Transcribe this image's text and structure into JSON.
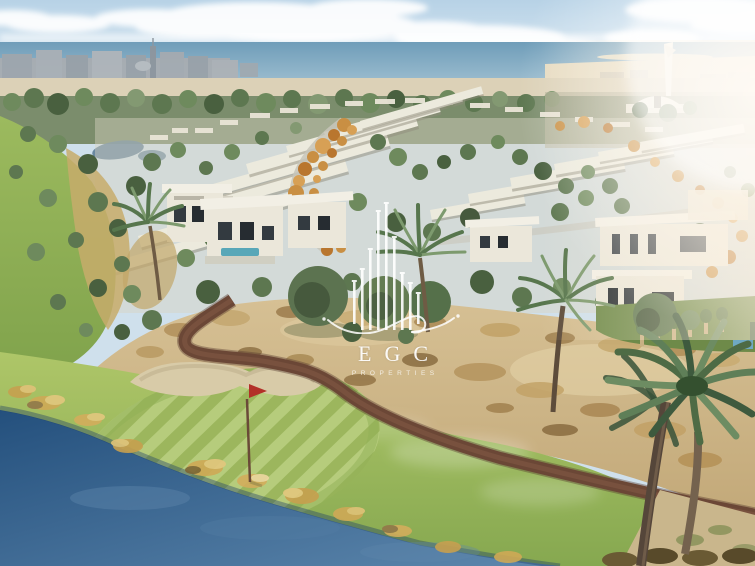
{
  "scene": {
    "alt": "Aerial architectural rendering of a seaside golf-course villa community: white flat-roof villas among green and autumn trees, a mosque with minaret near the shoreline, a striped putting green with red flag, sand bunker, desert scrub, winding brown cart path, blue pond with golden reeds and foreground date palms."
  },
  "watermark": {
    "name": "EGC",
    "subtitle": "PROPERTIES"
  },
  "colors": {
    "sky_top": "#b7d2e6",
    "sky_bottom": "#ebf3f8",
    "sea_dark": "#6f9db9",
    "sea_light": "#aac7d6",
    "beach": "#dcd1b7",
    "skyline": "#a3aab1",
    "treeline": "#7b8d6c",
    "villa": "#ebe7da",
    "autumn": "#c98f43",
    "fairway": "#8fae53",
    "green_light": "#a6c063",
    "desert": "#ccb386",
    "rough_gold": "#c7ab6b",
    "pond_dark": "#24507d",
    "pond_light": "#5d87ad",
    "cart_path": "#6b4736",
    "flag": "#b23028",
    "palm": "#4e6b45",
    "trunk": "#55463a",
    "reed_gold": "#d3ad5c",
    "glare": "#fff1dd"
  }
}
